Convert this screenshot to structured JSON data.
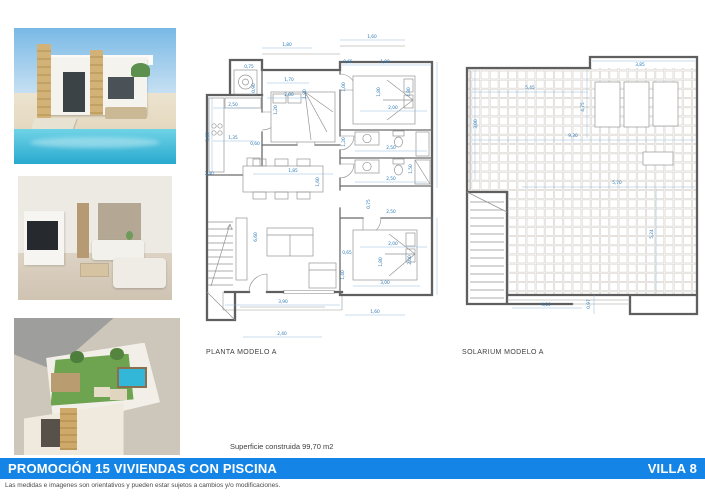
{
  "photos": [
    {
      "name": "villa-exterior-photo",
      "alt": "Villa with private pool"
    },
    {
      "name": "living-room-photo",
      "alt": "Interior living room"
    },
    {
      "name": "rooftop-solarium-photo",
      "alt": "Rooftop solarium aerial view"
    }
  ],
  "plans": {
    "dim_color": "#2b7ab8",
    "planta": {
      "label": "PLANTA MODELO A",
      "dims": [
        {
          "t": "1,80",
          "x": 82,
          "y": 14
        },
        {
          "t": "1,60",
          "x": 167,
          "y": 6
        },
        {
          "t": "0,75",
          "x": 44,
          "y": 36
        },
        {
          "t": "0,90",
          "x": 50,
          "y": 56,
          "r": -90
        },
        {
          "t": "1,70",
          "x": 84,
          "y": 49
        },
        {
          "t": "2,00",
          "x": 84,
          "y": 64
        },
        {
          "t": "1,20",
          "x": 72,
          "y": 78,
          "r": -90
        },
        {
          "t": "1,80",
          "x": 101,
          "y": 62,
          "r": -90
        },
        {
          "t": "0,65",
          "x": 143,
          "y": 31
        },
        {
          "t": "1,00",
          "x": 180,
          "y": 31
        },
        {
          "t": "1,00",
          "x": 140,
          "y": 55,
          "r": -90
        },
        {
          "t": "1,80",
          "x": 175,
          "y": 60,
          "r": -90
        },
        {
          "t": "1,80",
          "x": 205,
          "y": 60,
          "r": -90
        },
        {
          "t": "2,00",
          "x": 188,
          "y": 77
        },
        {
          "t": "2,50",
          "x": 28,
          "y": 74
        },
        {
          "t": "3,65",
          "x": 4,
          "y": 105,
          "r": -90
        },
        {
          "t": "1,35",
          "x": 28,
          "y": 107
        },
        {
          "t": "0,60",
          "x": 50,
          "y": 113
        },
        {
          "t": "0,40",
          "x": 4,
          "y": 143
        },
        {
          "t": "2,50",
          "x": 186,
          "y": 117
        },
        {
          "t": "1,20",
          "x": 140,
          "y": 110,
          "r": -90
        },
        {
          "t": "1,50",
          "x": 207,
          "y": 137,
          "r": -90
        },
        {
          "t": "2,50",
          "x": 186,
          "y": 148
        },
        {
          "t": "0,75",
          "x": 165,
          "y": 172,
          "r": -90
        },
        {
          "t": "2,50",
          "x": 186,
          "y": 181
        },
        {
          "t": "1,85",
          "x": 88,
          "y": 140
        },
        {
          "t": "1,60",
          "x": 114,
          "y": 150,
          "r": -90
        },
        {
          "t": "6,60",
          "x": 52,
          "y": 205,
          "r": -90
        },
        {
          "t": "2,00",
          "x": 188,
          "y": 213
        },
        {
          "t": "1,80",
          "x": 177,
          "y": 230,
          "r": -90
        },
        {
          "t": "2,00",
          "x": 206,
          "y": 228,
          "r": -90
        },
        {
          "t": "0,65",
          "x": 142,
          "y": 222
        },
        {
          "t": "1,40",
          "x": 139,
          "y": 243,
          "r": -90
        },
        {
          "t": "3,00",
          "x": 180,
          "y": 252
        },
        {
          "t": "1,60",
          "x": 170,
          "y": 281
        },
        {
          "t": "3,90",
          "x": 78,
          "y": 271
        },
        {
          "t": "2,40",
          "x": 77,
          "y": 303
        }
      ]
    },
    "solarium": {
      "label": "SOLARIUM MODELO A",
      "dims": [
        {
          "t": "3,85",
          "x": 178,
          "y": 14
        },
        {
          "t": "5,45",
          "x": 68,
          "y": 37
        },
        {
          "t": "3,00",
          "x": 15,
          "y": 72,
          "r": -90
        },
        {
          "t": "4,75",
          "x": 122,
          "y": 55,
          "r": -90
        },
        {
          "t": "9,30",
          "x": 111,
          "y": 85
        },
        {
          "t": "5,70",
          "x": 155,
          "y": 132
        },
        {
          "t": "5,24",
          "x": 191,
          "y": 182,
          "r": -90
        },
        {
          "t": "4,10",
          "x": 84,
          "y": 254
        },
        {
          "t": "0,97",
          "x": 128,
          "y": 252,
          "r": -90
        }
      ]
    }
  },
  "notes": {
    "area": "Superficie construida 99,70 m2"
  },
  "banner": {
    "title": "PROMOCIÓN 15 VIVIENDAS CON PISCINA",
    "model": "VILLA 8",
    "color": "#1485e6"
  },
  "disclaimer": "Las medidas e imagenes son orientativos y pueden estar sujetos a cambios y/o modificaciones."
}
